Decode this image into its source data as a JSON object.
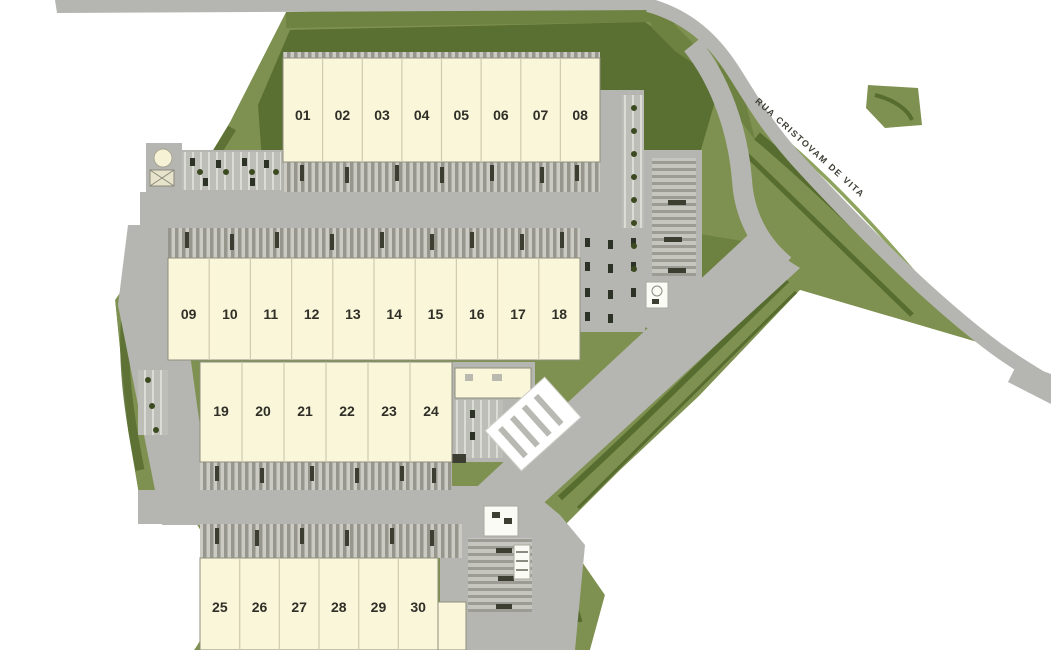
{
  "site": {
    "road_label": "RUA CRISTOVAM DE VITA",
    "buildings": [
      {
        "id": "building-1",
        "units": [
          "01",
          "02",
          "03",
          "04",
          "05",
          "06",
          "07",
          "08"
        ]
      },
      {
        "id": "building-2",
        "units": [
          "09",
          "10",
          "11",
          "12",
          "13",
          "14",
          "15",
          "16",
          "17",
          "18"
        ]
      },
      {
        "id": "building-3",
        "units": [
          "19",
          "20",
          "21",
          "22",
          "23",
          "24"
        ]
      },
      {
        "id": "building-4",
        "units": [
          "25",
          "26",
          "27",
          "28",
          "29",
          "30"
        ]
      }
    ],
    "colors": {
      "green_light": "#7e9150",
      "green_mid": "#6d8140",
      "green_dark": "#576c2f",
      "road_gray": "#b5b6b1",
      "building_cream": "#f9f6da"
    }
  }
}
